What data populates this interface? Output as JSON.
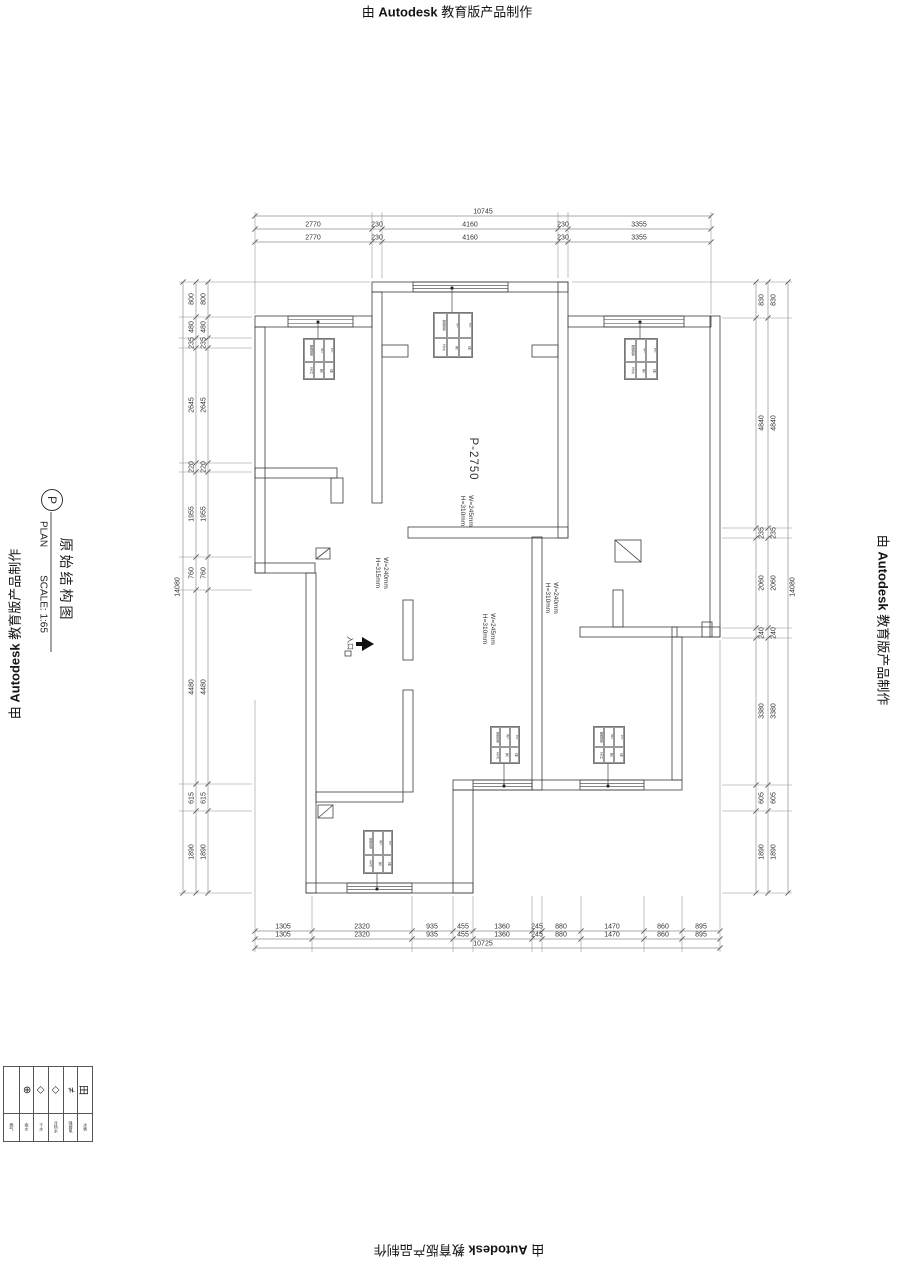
{
  "watermark": {
    "prefix": "由",
    "brand": "Autodesk",
    "suffix": "教育版产品制作"
  },
  "title_block": {
    "bubble": "P",
    "plan": "PLAN",
    "scale": "SCALE:  1:65",
    "name": "原始结构图"
  },
  "plan": {
    "room_label": "P-2750",
    "entrance": "入口",
    "annotations": {
      "a1": "W=245mm\nH=310mm",
      "a2": "W=240mm\nH=315mm",
      "a3": "W=245mm\nH=310mm",
      "a4": "W=240mm\nH=310mm"
    }
  },
  "dims": {
    "top": {
      "total": "10745",
      "row": [
        "2770",
        "230",
        "4160",
        "230",
        "3355"
      ]
    },
    "bottom": {
      "total": "10725",
      "row": [
        "1305",
        "2320",
        "935",
        "455",
        "1360",
        "245",
        "880",
        "1470",
        "860",
        "895"
      ]
    },
    "left": {
      "total": "14080",
      "row": [
        "800",
        "480",
        "235",
        "2645",
        "220",
        "1955",
        "760",
        "4480",
        "615",
        "1890"
      ]
    },
    "right": {
      "total": "14080",
      "row": [
        "830",
        "4840",
        "235",
        "2060",
        "240",
        "3380",
        "605",
        "1890"
      ]
    }
  },
  "window_tag": {
    "cells": [
      "塑钢窗",
      "W=",
      "H=",
      "平开",
      "宽",
      "高"
    ]
  },
  "legend": {
    "items": [
      {
        "symbol": "",
        "label": "燃气"
      },
      {
        "symbol": "⊕",
        "label": "雨水"
      },
      {
        "symbol": "◇",
        "label": "下水"
      },
      {
        "symbol": "◇",
        "label": "冷热水"
      },
      {
        "symbol": "≠",
        "label": "强弱电"
      },
      {
        "symbol": "田",
        "label": "水表"
      }
    ]
  },
  "colors": {
    "wall": "#3c3c3c",
    "dim": "#909090",
    "text": "#333333"
  }
}
